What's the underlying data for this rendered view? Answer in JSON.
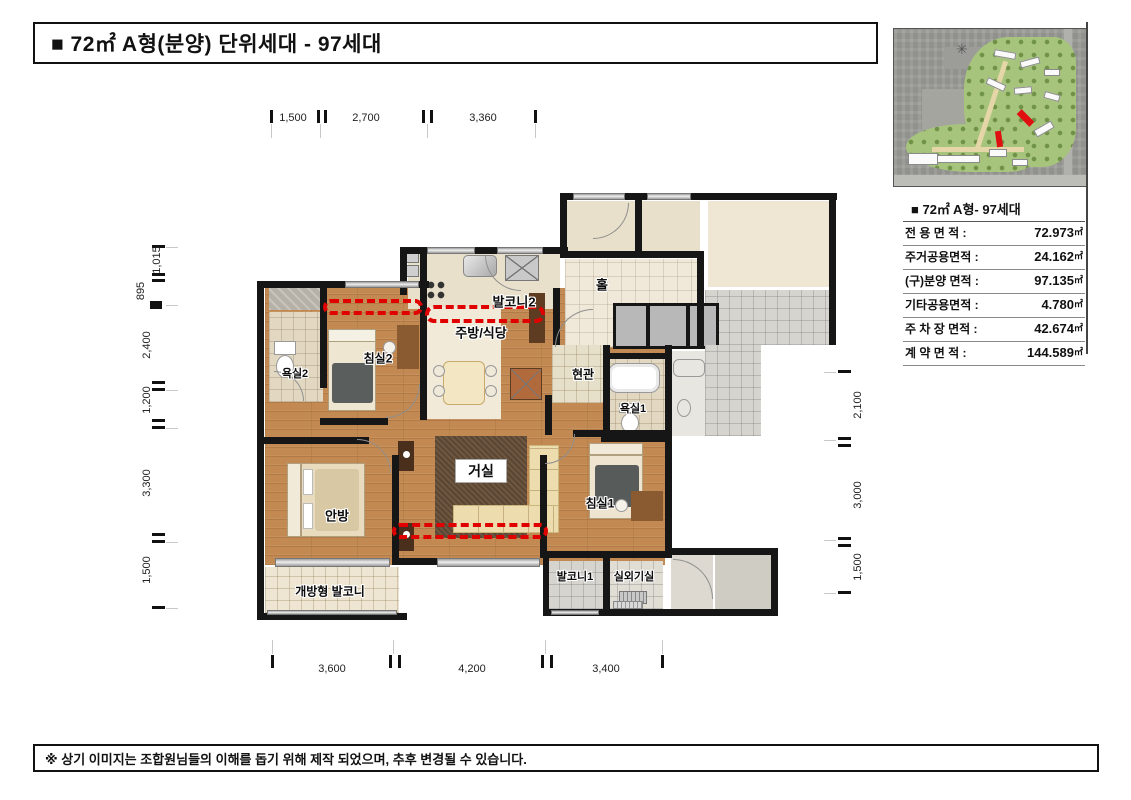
{
  "page": {
    "title": "■ 72㎡ A형(분양) 단위세대 - 97세대",
    "footer": "※ 상기 이미지는 조합원님들의 이해를 돕기 위해 제작 되었으며, 추후 변경될 수 있습니다."
  },
  "info_table": {
    "header": "■ 72㎡ A형- 97세대",
    "rows": [
      {
        "label": "전 용 면 적 :",
        "value": "72.973",
        "unit": "㎡"
      },
      {
        "label": "주거공용면적 :",
        "value": "24.162",
        "unit": "㎡"
      },
      {
        "label": "(구)분양 면적 :",
        "value": "97.135",
        "unit": "㎡"
      },
      {
        "label": "기타공용면적 :",
        "value": "4.780",
        "unit": "㎡"
      },
      {
        "label": "주 차 장 면적 :",
        "value": "42.674",
        "unit": "㎡"
      },
      {
        "label": "계 약 면 적 :",
        "value": "144.589",
        "unit": "㎡"
      }
    ]
  },
  "floor_plan": {
    "rooms": [
      {
        "name": "balcony-2",
        "label": "발코니2"
      },
      {
        "name": "kitchen-dining",
        "label": "주방/식당"
      },
      {
        "name": "bedroom-2",
        "label": "침실2"
      },
      {
        "name": "bathroom-2",
        "label": "욕실2"
      },
      {
        "name": "entrance",
        "label": "현관"
      },
      {
        "name": "bathroom-1",
        "label": "욕실1"
      },
      {
        "name": "hall",
        "label": "홀"
      },
      {
        "name": "living-room",
        "label": "거실"
      },
      {
        "name": "master-bedroom",
        "label": "안방"
      },
      {
        "name": "bedroom-1",
        "label": "침실1"
      },
      {
        "name": "open-balcony",
        "label": "개방형 발코니"
      },
      {
        "name": "balcony-1",
        "label": "발코니1"
      },
      {
        "name": "ac-room",
        "label": "실외기실"
      }
    ],
    "dimensions": {
      "top": [
        "1,500",
        "2,700",
        "3,360"
      ],
      "bottom": [
        "3,600",
        "4,200",
        "3,400"
      ],
      "left": [
        "1,015",
        "895",
        "2,400",
        "1,200",
        "3,300",
        "1,500"
      ],
      "right": [
        "2,100",
        "3,000",
        "1,500"
      ]
    }
  },
  "colors": {
    "wall": "#161616",
    "wood_floor": "#c28a52",
    "red_dashline": "#e00000",
    "site_green": "#a7c47c"
  }
}
